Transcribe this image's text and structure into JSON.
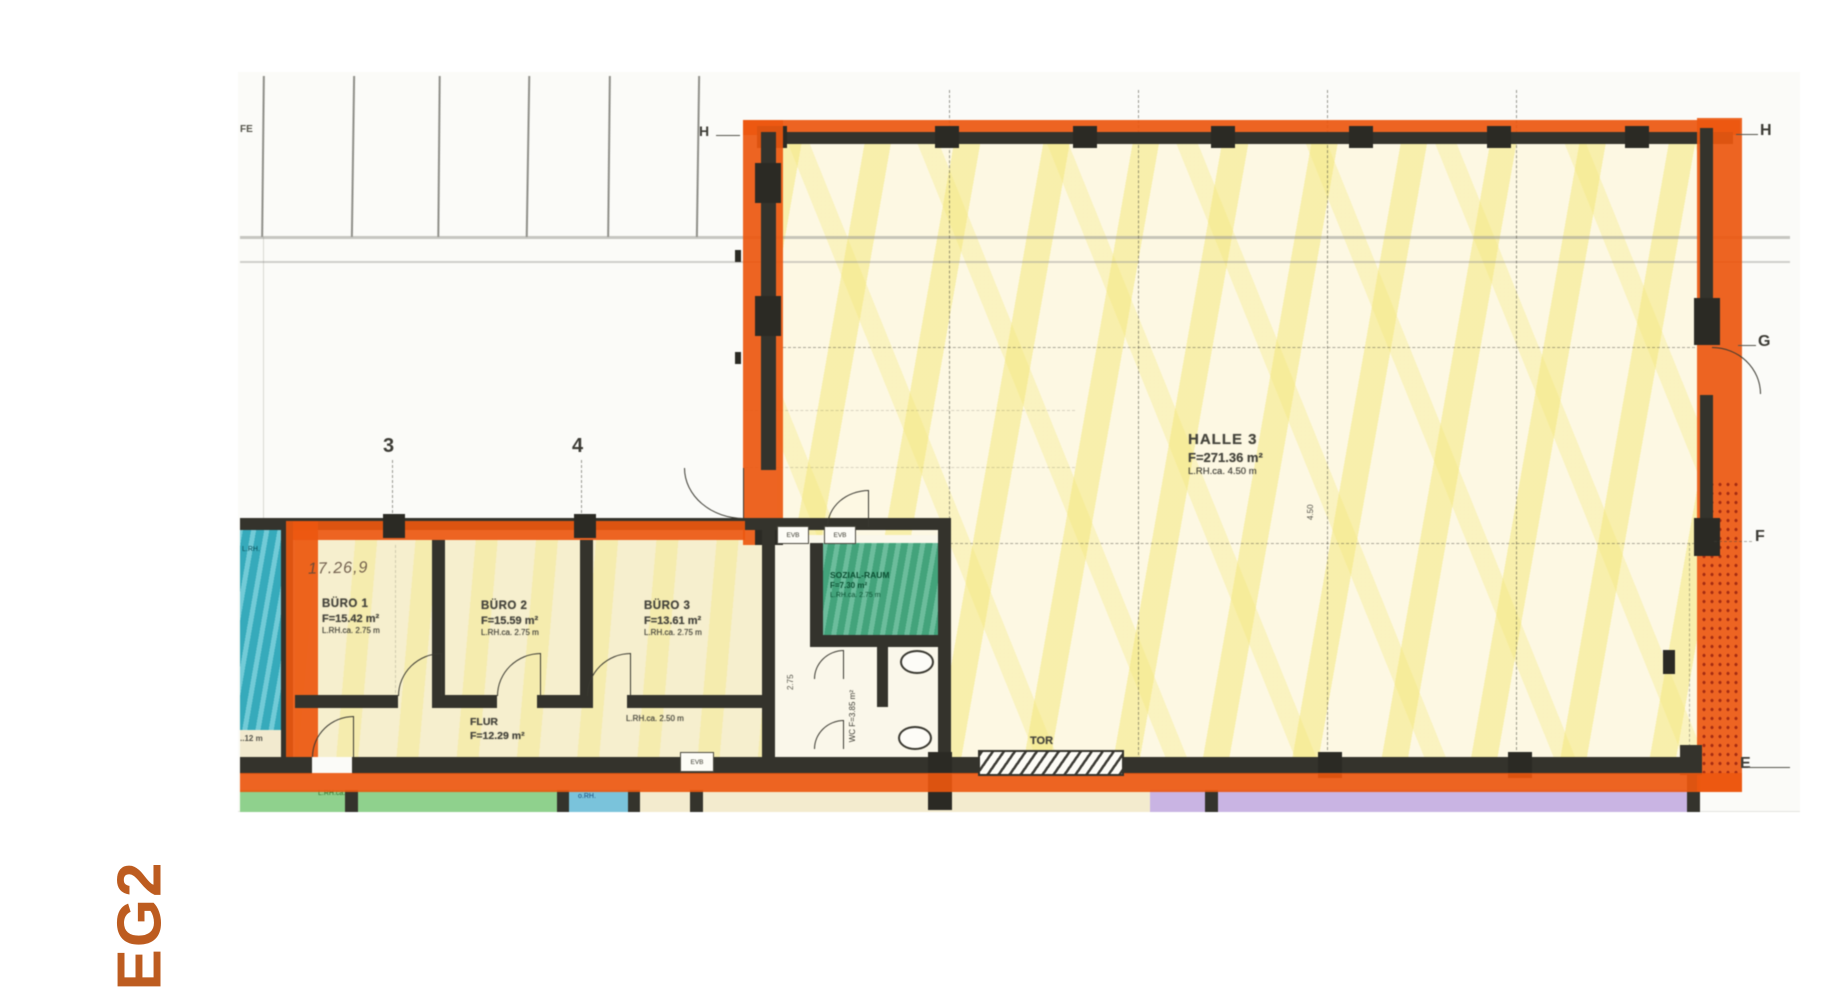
{
  "floor_label": "EG2",
  "grid": {
    "col_3": "3",
    "col_4": "4",
    "row_h_left": "H",
    "row_h": "H",
    "row_g": "G",
    "row_f": "F",
    "row_e": "E",
    "corner": "FE"
  },
  "rooms": {
    "halle3": {
      "name": "HALLE 3",
      "area": "F=271.36 m²",
      "height": "L.RH.ca. 4.50 m"
    },
    "buero1": {
      "name": "BÜRO 1",
      "area": "F=15.42 m²",
      "height": "L.RH.ca. 2.75 m"
    },
    "buero2": {
      "name": "BÜRO 2",
      "area": "F=15.59 m²",
      "height": "L.RH.ca. 2.75 m"
    },
    "buero3": {
      "name": "BÜRO 3",
      "area": "F=13.61 m²",
      "height": "L.RH.ca. 2.75 m"
    },
    "flur": {
      "name": "FLUR",
      "area": "F=12.29 m²"
    },
    "flur_height_note": "L.RH.ca. 2.50 m",
    "sozialraum": {
      "name": "SOZIAL-RAUM",
      "area": "F=7.30 m²",
      "height": "L.RH.ca. 2.75 m"
    },
    "wc": {
      "name": "WC",
      "area": "F=3.85 m²"
    }
  },
  "annotations": {
    "tor": "TOR",
    "evb_1": "EVB",
    "evb_2": "EVB",
    "evb_3": "EVB",
    "handwritten": "17.26,9",
    "left_cut_label": "..12 m",
    "cyan_fragment": "L.RH.",
    "green_fragment_1": "L.RH.ca.",
    "green_fragment_2": "o.RH.",
    "hall_column_dim": "4.50",
    "corridor_dim": "2.75"
  },
  "colors": {
    "highlight_orange": "#e85812",
    "wall_black": "#34332c",
    "floor_label_orange": "#bd5c20",
    "hall_yellow": "#f3e678",
    "cyan_room": "#3fb6c6",
    "social_green": "#4fae87",
    "green_strip": "#90d08e",
    "blue_strip": "#7cc3da",
    "lavender_strip": "#c9b4e2"
  }
}
